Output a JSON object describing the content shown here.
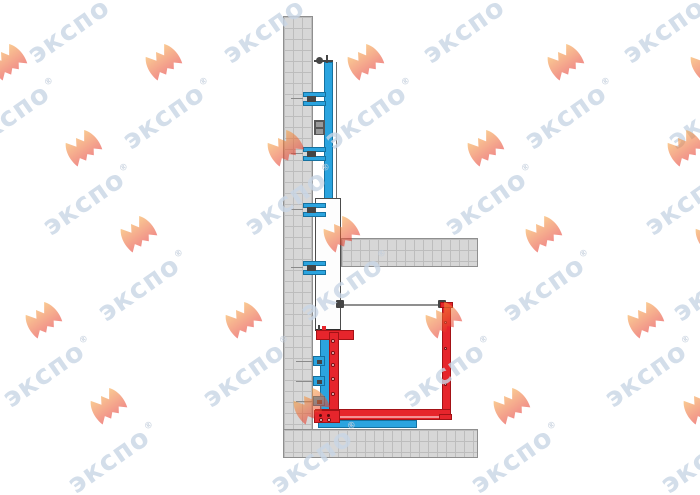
{
  "page": {
    "background": "#ffffff"
  },
  "watermark": {
    "brand_text": "экспо",
    "registered_mark": "®",
    "text_color": "#c9d6e6",
    "logo_gradient_top": "#F6A13B",
    "logo_gradient_bottom": "#E63229"
  },
  "diagram": {
    "type": "technical-elevation-drawing",
    "colors": {
      "structure_gray": "#d7d7d7",
      "hatch_line": "#bdbdbd",
      "structure_outline": "#8f8f8f",
      "mast_blue": "#2BA4DF",
      "blue_edge": "#15719F",
      "frame_red": "#E6252C",
      "red_edge": "#A31216",
      "car_white": "#fdfdfd",
      "rail_gray": "#8f8f8f"
    }
  }
}
